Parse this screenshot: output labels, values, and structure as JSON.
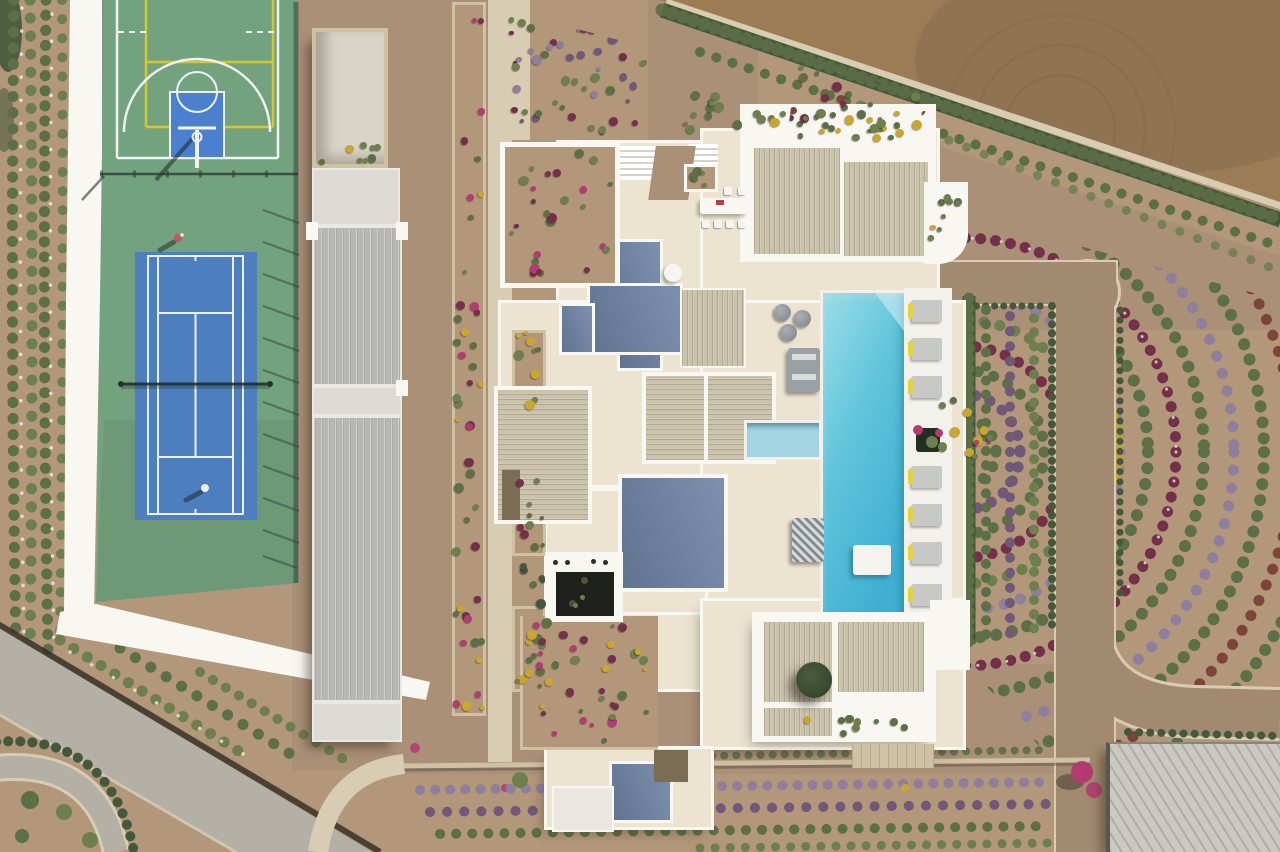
{
  "scene": {
    "type": "aerial drone photograph, straight-down view",
    "subject": "modern white luxury villa estate with pool, sports courts and landscaped grounds",
    "lighting": "hard midday sun, shadows cast to the lower-left",
    "areas": {
      "sports_zone": {
        "basketball_court": {
          "surface": "green acrylic",
          "key_color": "blue",
          "line_colors": [
            "white",
            "yellow"
          ],
          "hoops": 1
        },
        "tennis_court": {
          "surface": "blue acrylic",
          "surround": "green",
          "line_color": "white",
          "players_visible": 2,
          "net_position": "center"
        }
      },
      "annex_building": {
        "description": "long outbuilding with two grey standing-seam metal roofs, concrete caps and a stone-walled roof deck with planter"
      },
      "villa": {
        "roof_types": [
          "white parapet terraces",
          "beige pergola slats",
          "slate-blue flat roofs"
        ],
        "courtyards": [
          "bougainvillea walled garden",
          "dark sunken courtyard with portholes",
          "shrub garden with clipped bushes"
        ],
        "rooftop_planting": "green and yellow shrubs along parapets"
      },
      "pool_zone": {
        "pool": "elongated rectangular turquoise pool",
        "features": [
          "corner entry steps",
          "white in-pool day bed",
          "kids pool",
          "potted bougainvillea on edge"
        ],
        "sun_loungers": 8,
        "poufs": 3,
        "sofas": 2
      },
      "outdoor_dining": {
        "table": "white rectangular table",
        "chairs": 6
      },
      "landscape": [
        "olive grove in rows",
        "oleander hedges with white blooms",
        "lavender rows",
        "concentric arcs of clipped shrubs",
        "magenta bougainvillea",
        "ploughed dirt field with tractor arcs",
        "triangular parterre beds"
      ],
      "circulation": [
        "white perimeter path",
        "grey asphalt road (diagonal, lower left)",
        "stone-paved driveway with rounded corners",
        "curved garden paths"
      ]
    }
  },
  "palette": {
    "soil": "#b2977a",
    "soilDark": "#a38866",
    "paving": "#ab9078",
    "dirtField": "#9c7c54",
    "dirtFieldDark": "#846b4e",
    "roadGray": "#b5b0a5",
    "driveBrown": "#a18a70",
    "pathLight": "#d8ccb2",
    "stone": "#cfc2a4",
    "wallWhite": "#f8f7f2",
    "cream": "#ece4d1",
    "khaki": "#cbc2ac",
    "slate": "#6d819f",
    "annexRoof": "#b7b8b4",
    "annexCap": "#dbdad4",
    "annexDeck": "#d8d4c8",
    "courtGreen": "#73a27e",
    "courtBlue": "#4d7fc0",
    "keyBlue": "#4b80cf",
    "lineWhite": "#eef1f3",
    "lineYellow": "#d9c533",
    "poolDeep": "#3fb0d2",
    "poolMid": "#60c4db",
    "poolLight": "#9bdde8",
    "kidsPool": "#a3d6e2",
    "hedgeGreen": "#44583b",
    "olive": "#5c6f47",
    "shrubGreen": "#6e7f4f",
    "lavender": "#8e7f9c",
    "purpleDark": "#6f5878",
    "burgundy": "#74304a",
    "rust": "#7d453a",
    "magenta": "#b23b72",
    "yellowFlower": "#c8a62f",
    "loungerYellow": "#e6d23e",
    "sofaGray": "#9aa1a5",
    "darkSlat": "#7b6c54",
    "poolDeckWhite": "#f2f1ec"
  }
}
